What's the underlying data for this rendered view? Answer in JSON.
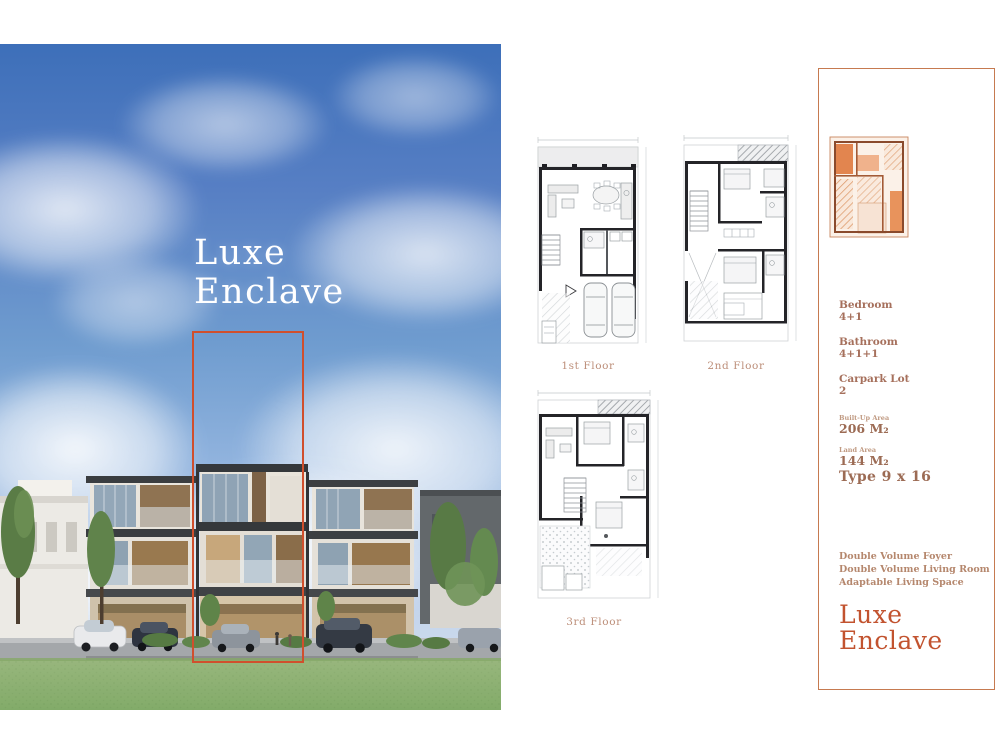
{
  "hero": {
    "title_line1": "Luxe",
    "title_line2": "Enclave"
  },
  "floor_plans": {
    "first": {
      "label": "1st Floor"
    },
    "second": {
      "label": "2nd Floor"
    },
    "third": {
      "label": "3rd Floor"
    }
  },
  "info_panel": {
    "specs": [
      {
        "label": "Bedroom",
        "value": "4+1"
      },
      {
        "label": "Bathroom",
        "value": "4+1+1"
      },
      {
        "label": "Carpark Lot",
        "value": "2"
      }
    ],
    "areas": [
      {
        "label": "Built-Up Area",
        "value": "206 M₂"
      },
      {
        "label": "Land Area",
        "value": "144 M₂"
      }
    ],
    "type_label": "Type 9 x 16",
    "features": [
      "Double Volume Foyer",
      "Double Volume Living Room",
      "Adaptable Living Space"
    ],
    "title_line1": "Luxe",
    "title_line2": "Enclave"
  },
  "colors": {
    "accent_title": "#c2532f",
    "panel_border": "#c67a50",
    "highlight_box": "#d04f2d",
    "spec_text": "#a6705c",
    "plan_label": "#bd8f7a",
    "sky_top": "#3d6fb9",
    "lawn": "#7fa763"
  }
}
